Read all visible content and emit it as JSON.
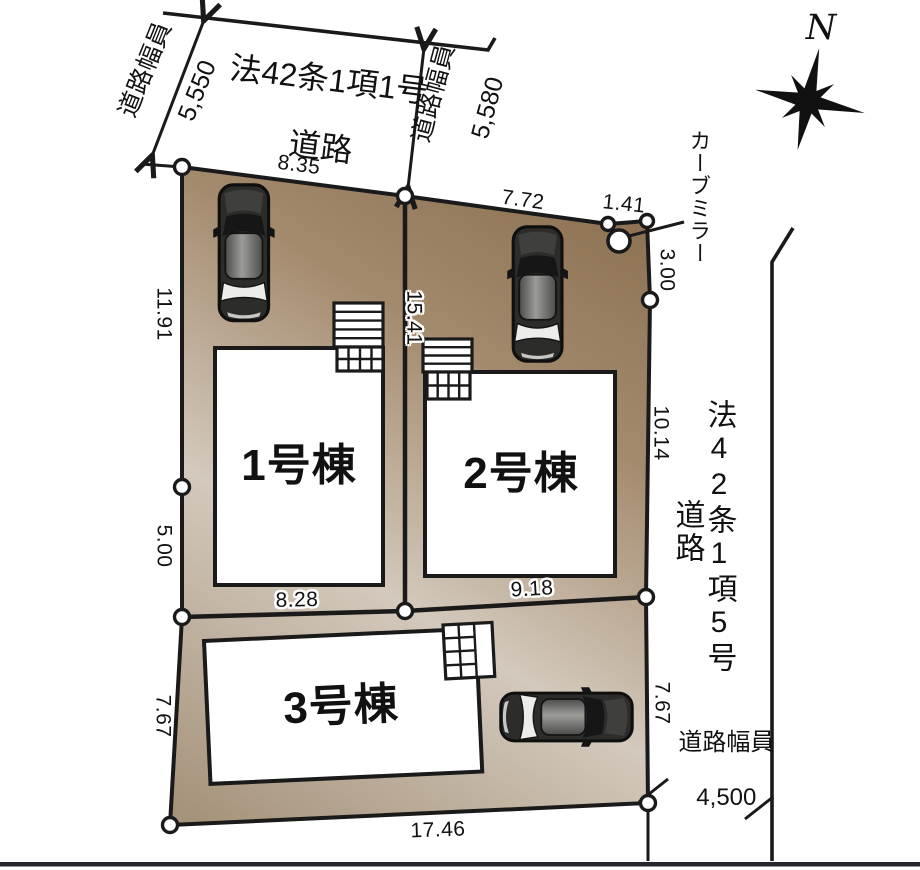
{
  "compass": {
    "north_label": "N"
  },
  "roads": {
    "top": {
      "name_line1": "法42条1項1号",
      "name_line2": "道路",
      "width_caption_left": "道路幅員",
      "width_left": "5,550",
      "width_caption_right": "道路幅員",
      "width_right": "5,580"
    },
    "right": {
      "name_col1": "法42条1項5号",
      "name_col2": "道路",
      "width_caption": "道路幅員",
      "width_value": "4,500"
    }
  },
  "annotations": {
    "curve_mirror": "カーブミラー"
  },
  "buildings": [
    {
      "label": "1号棟"
    },
    {
      "label": "2号棟"
    },
    {
      "label": "3号棟"
    }
  ],
  "dimensions": {
    "top_west_edge": "8.35",
    "top_east_edge": "7.72",
    "corner_northeast": "1.41",
    "right_upper": "3.00",
    "right_middle": "10.14",
    "right_lower": "7.67",
    "left_upper": "11.91",
    "left_middle": "5.00",
    "left_lower": "7.67",
    "bottom_edge": "17.46",
    "center_divider": "15.41",
    "lot1_south": "8.28",
    "lot2_south": "9.18"
  },
  "colors": {
    "plot_dark": "#8a6f50",
    "plot_mid": "#a48a6d",
    "plot_light": "#d3c9bc",
    "plot_low": "#a6937b",
    "line": "#1a1a1a",
    "bottom_bar": "#26262e",
    "node_fill": "#ffffff"
  }
}
